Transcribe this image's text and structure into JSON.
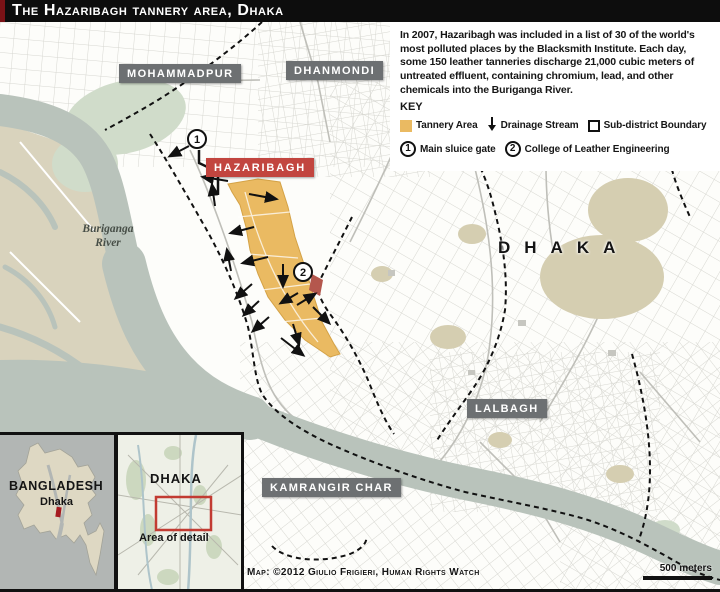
{
  "title": "The Hazaribagh tannery area, Dhaka",
  "info": {
    "paragraph": "In 2007, Hazaribagh was included in a list of 30 of the world's most polluted places by the Blacksmith Institute. Each day, some 150 leather tanneries discharge 21,000 cubic meters of untreated effluent, containing chromium, lead, and other chemicals into the Buriganga River.",
    "key_title": "KEY",
    "legend": {
      "tannery": "Tannery Area",
      "drainage": "Drainage Stream",
      "boundary": "Sub-district Boundary",
      "sluice_num": "1",
      "sluice": "Main sluice gate",
      "college_num": "2",
      "college": "College of Leather Engineering"
    }
  },
  "map_labels": {
    "mohammadpur": "MOHAMMADPUR",
    "dhanmondi": "DHANMONDI",
    "hazaribagh": "HAZARIBAGH",
    "dhaka": "DHAKA",
    "lalbagh": "LALBAGH",
    "kamrangir": "KAMRANGIR CHAR",
    "river_line1": "Buriganga",
    "river_line2": "River",
    "marker1": "1",
    "marker2": "2"
  },
  "insets": {
    "bangladesh_label": "BANGLADESH",
    "bangladesh_city": "Dhaka",
    "dhaka_label": "DHAKA",
    "dhaka_caption": "Area of detail"
  },
  "credit": "Map: ©2012 Giulio Frigieri, Human Rights Watch",
  "scale_label": "500 meters",
  "colors": {
    "tannery_area": "#eaba62",
    "water": "#b9c3bb",
    "west_land": "#d9d3bd",
    "park": "#d0dcca",
    "khaki_area": "#d5ceb1",
    "district_box": "#6d7072",
    "hazaribagh_box": "#c2453f",
    "detail_rect_red": "#c23b32",
    "title_bg": "#0d0d0d"
  }
}
